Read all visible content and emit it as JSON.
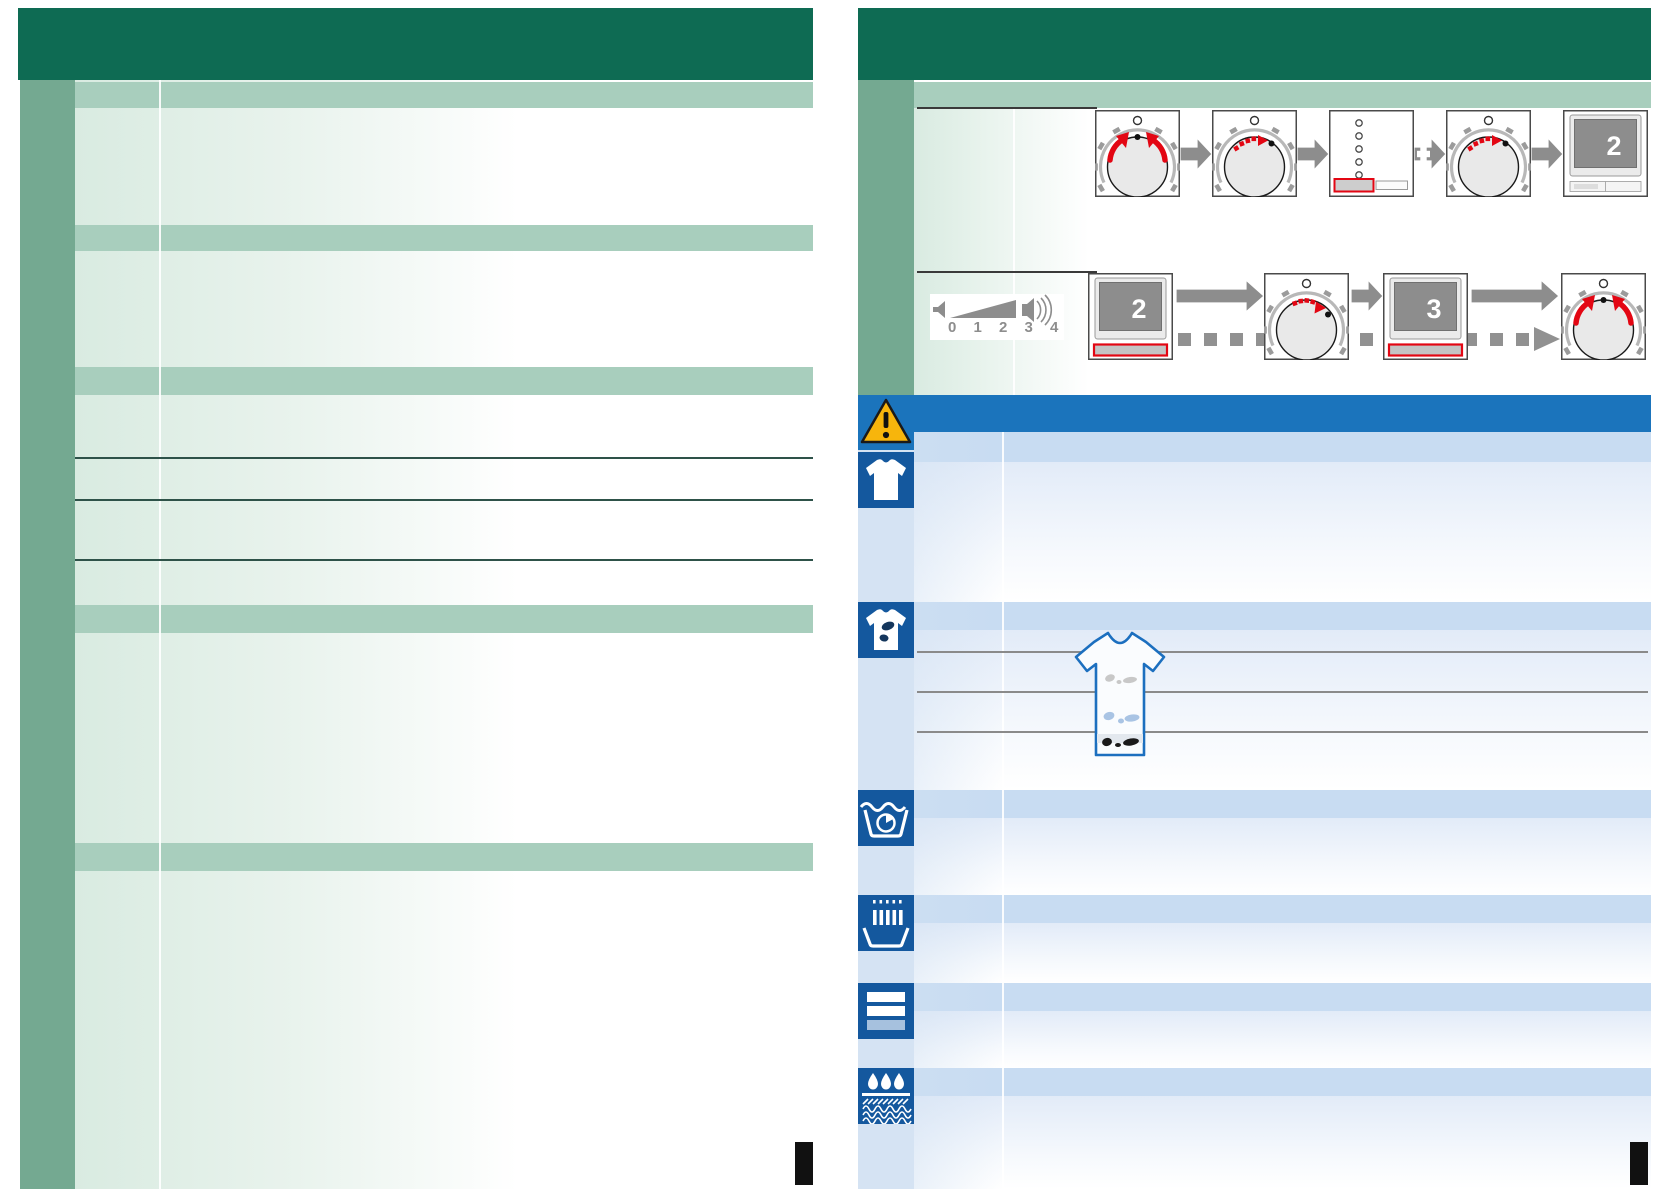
{
  "document_kind": "appliance instruction manual spread (scanned, text-free template)",
  "right_page": {
    "flow_row1": {
      "steps": [
        "dial-rotate-both-directions",
        "dial-step-adjust",
        "option-buttons-panel",
        "dial-step-adjust",
        "display-screen"
      ],
      "display_value": "2",
      "plus_label": "+"
    },
    "flow_row2": {
      "volume_scale": "0 1 2 3 4",
      "display_start_value": "2",
      "display_end_value": "3",
      "steps": [
        "volume-scale",
        "display-screen",
        "dial-step-adjust",
        "display-screen",
        "dial-rotate-both-directions"
      ]
    },
    "care_row_icons": [
      "warning-triangle",
      "white-shirt",
      "stained-shirt",
      "wash-tub-timer",
      "basin-with-bars",
      "detergent-drawer",
      "water-drops-on-fabric"
    ],
    "stain_levels": [
      "light-gray-stains",
      "medium-blue-stains",
      "heavy-dark-stains"
    ]
  },
  "colors": {
    "header_green": "#0e6b53",
    "sidebar_green": "#74a991",
    "band_green": "#a8cebd",
    "warning_bar_blue": "#1b74bc",
    "care_icon_blue": "#14589e",
    "row_band_blue": "#c8dcf2",
    "accent_red": "#e30613",
    "arrow_gray": "#8d8d8d",
    "warning_yellow": "#f7b50c"
  }
}
